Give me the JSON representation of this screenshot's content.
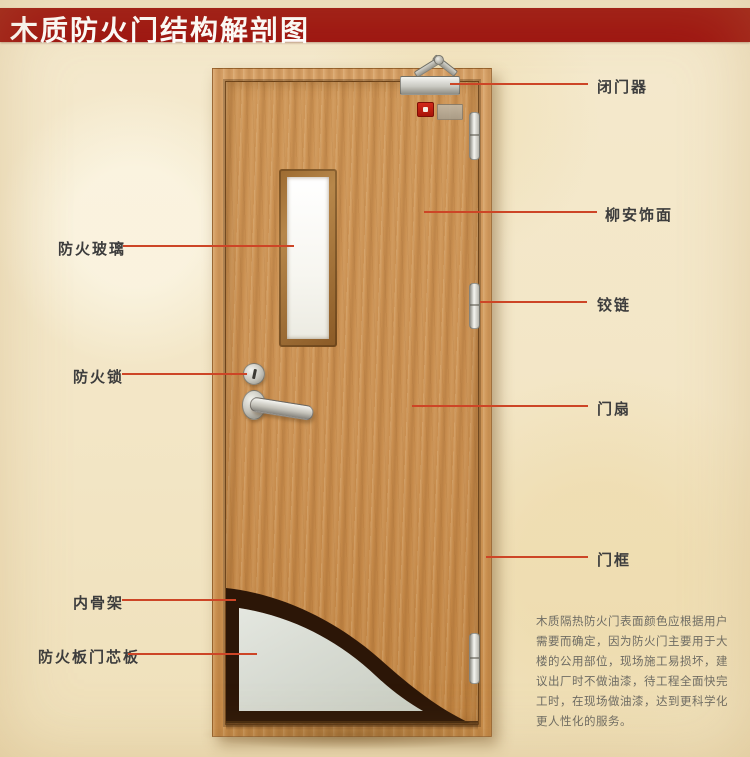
{
  "title": "木质防火门结构解剖图",
  "callouts": {
    "left": [
      {
        "id": "fire-glass",
        "text": "防火玻璃"
      },
      {
        "id": "fire-lock",
        "text": "防火锁"
      },
      {
        "id": "inner-skeleton",
        "text": "内骨架"
      },
      {
        "id": "fire-board-core",
        "text": "防火板门芯板"
      }
    ],
    "right": [
      {
        "id": "door-closer",
        "text": "闭门器"
      },
      {
        "id": "lauan-veneer",
        "text": "柳安饰面"
      },
      {
        "id": "hinge",
        "text": "铰链"
      },
      {
        "id": "door-leaf",
        "text": "门扇"
      },
      {
        "id": "door-frame",
        "text": "门框"
      }
    ]
  },
  "description": {
    "lines": [
      "木质隔热防火门表面颜色应根据用户",
      "需要而确定，因为防火门主要用于大",
      "楼的公用部位，现场施工易损坏，建",
      "议出厂时不做油漆，待工程全面快完",
      "工时，在现场做油漆，达到更科学化",
      "更人性化的服务。"
    ]
  },
  "colors": {
    "banner_red": "#9e1410",
    "callout_line": "#cd4526",
    "door_wood": "#c8904e",
    "frame_wood": "#d09a5e",
    "core_panel": "#d9ddd3",
    "inner_skeleton": "#2c1607",
    "background_parchment": "#f3e7c9"
  }
}
